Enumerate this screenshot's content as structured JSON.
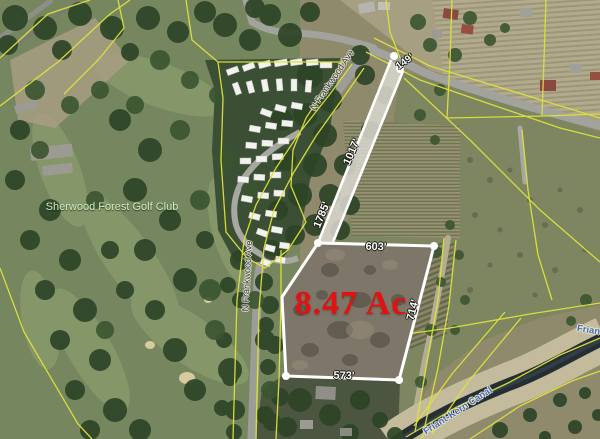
{
  "map": {
    "title": "aerial parcel map",
    "parcel": {
      "area_label": "8.47 Ac",
      "dimensions": {
        "frontage": "149'",
        "strip_upper": "1017'",
        "strip_lower": "1785'",
        "north": "603'",
        "east": "714'",
        "south": "573'"
      }
    },
    "labels": {
      "golf_club": "Sherwood Forest Golf Club",
      "street_top": "N Frankwood Ave",
      "street_side": "N Frankwood Ave",
      "canal": "Friant-Kern Canal",
      "canal_right": "Friant-Kern Canal"
    },
    "colors": {
      "parcel_outline": "#ffffff",
      "boundary_lines": "#dde23c",
      "area_text": "#e01212",
      "canal_text": "#4a6ba6",
      "golf_club_text": "#cfeec4",
      "street_text": "#34342c"
    }
  }
}
